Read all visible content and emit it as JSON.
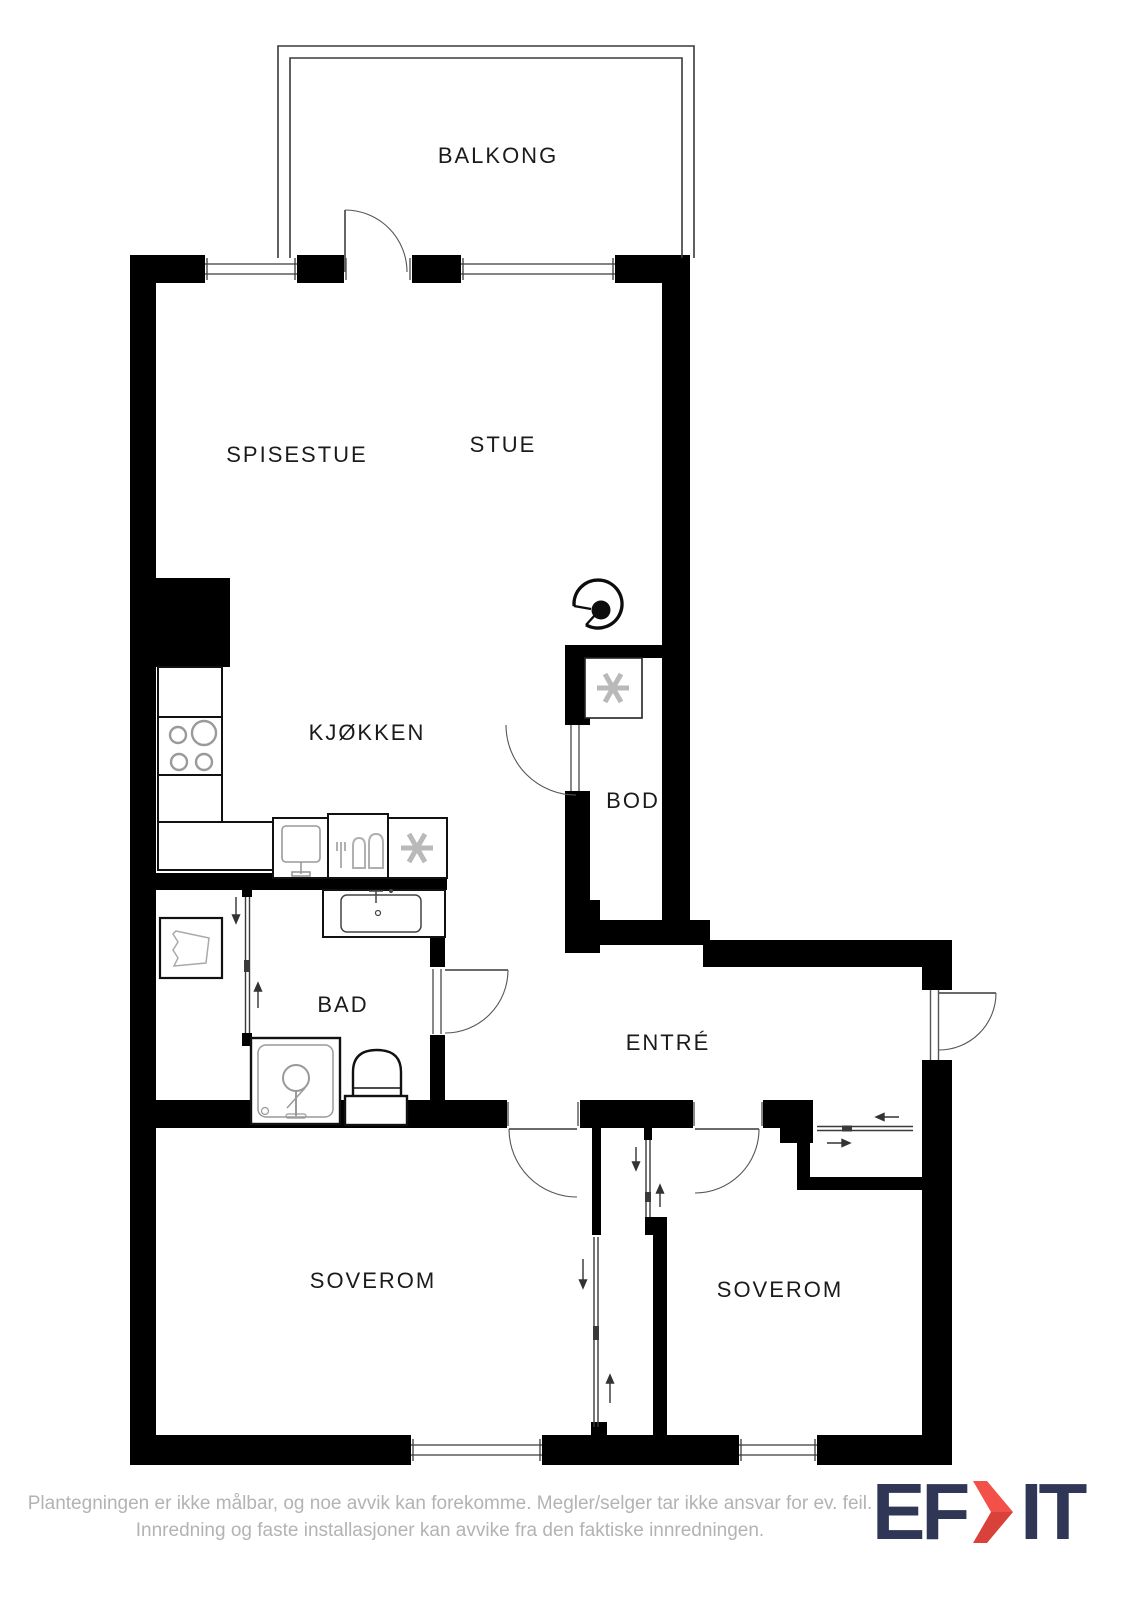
{
  "floorplan": {
    "rooms": {
      "balkong": {
        "label": "BALKONG"
      },
      "spisestue": {
        "label": "SPISESTUE"
      },
      "stue": {
        "label": "STUE"
      },
      "kjokken": {
        "label": "KJØKKEN"
      },
      "bod": {
        "label": "BOD"
      },
      "bad": {
        "label": "BAD"
      },
      "entre": {
        "label": "ENTRÉ"
      },
      "soverom_left": {
        "label": "SOVEROM"
      },
      "soverom_right": {
        "label": "SOVEROM"
      }
    },
    "fixtures": [
      "stove-hob-icon",
      "kitchen-sink-icon",
      "dishwasher-icon",
      "refrigerator-snowflake-icon",
      "freezer-snowflake-icon",
      "bathroom-vanity-icon",
      "shower-icon",
      "toilet-icon",
      "laundry-basket-icon",
      "fireplace-icon"
    ],
    "colors": {
      "wall": "#000000",
      "thin_line": "#3a3a3a",
      "fixture_gray": "#b0b0b0",
      "label_text": "#1b1b1b"
    }
  },
  "footer": {
    "disclaimer_line1": "Plantegningen er ikke målbar, og noe avvik kan forekomme. Megler/selger tar ikke ansvar for ev. feil.",
    "disclaimer_line2": "Innredning og faste installasjoner kan avvike fra den faktiske innredningen."
  },
  "logo": {
    "prefix": "EF",
    "suffix": "IT",
    "colors": {
      "navy": "#2f3656",
      "red": "#f25048",
      "red_dark": "#d8423b"
    }
  }
}
